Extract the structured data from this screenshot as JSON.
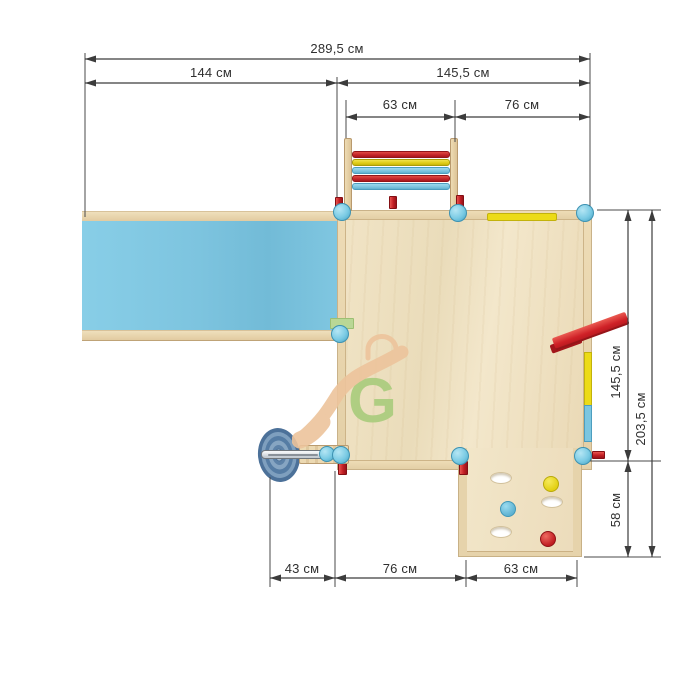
{
  "unit": "см",
  "dimensions": {
    "top_total": "289,5 см",
    "top_left": "144 см",
    "top_right": "145,5 см",
    "top_ladder": "63 см",
    "top_ladder_right": "76 см",
    "right_platform": "145,5 см",
    "right_total": "203,5 см",
    "right_wall": "58 см",
    "bottom_wheel": "43 см",
    "bottom_middle": "76 см",
    "bottom_wall": "63 см"
  },
  "watermark": {
    "letter": "G"
  },
  "parts": {
    "ladder_rung_colors": [
      "red",
      "yellow",
      "blue",
      "red",
      "blue"
    ],
    "climbing_wall_holds": [
      "yellow",
      "blue",
      "red"
    ],
    "climbing_wall_holes": 3
  },
  "colors": {
    "wood": "#f0e3c4",
    "wood_edge": "#e7d3ab",
    "slide_blue": "#7cc5e0",
    "post_blue": "#7bcbe4",
    "accent_red": "#c9252b",
    "accent_yellow": "#ecdb17",
    "logo_green": "#a9cc7c",
    "logo_orange": "#edc49c",
    "dimension_line": "#3c3c3c",
    "background": "#ffffff"
  }
}
